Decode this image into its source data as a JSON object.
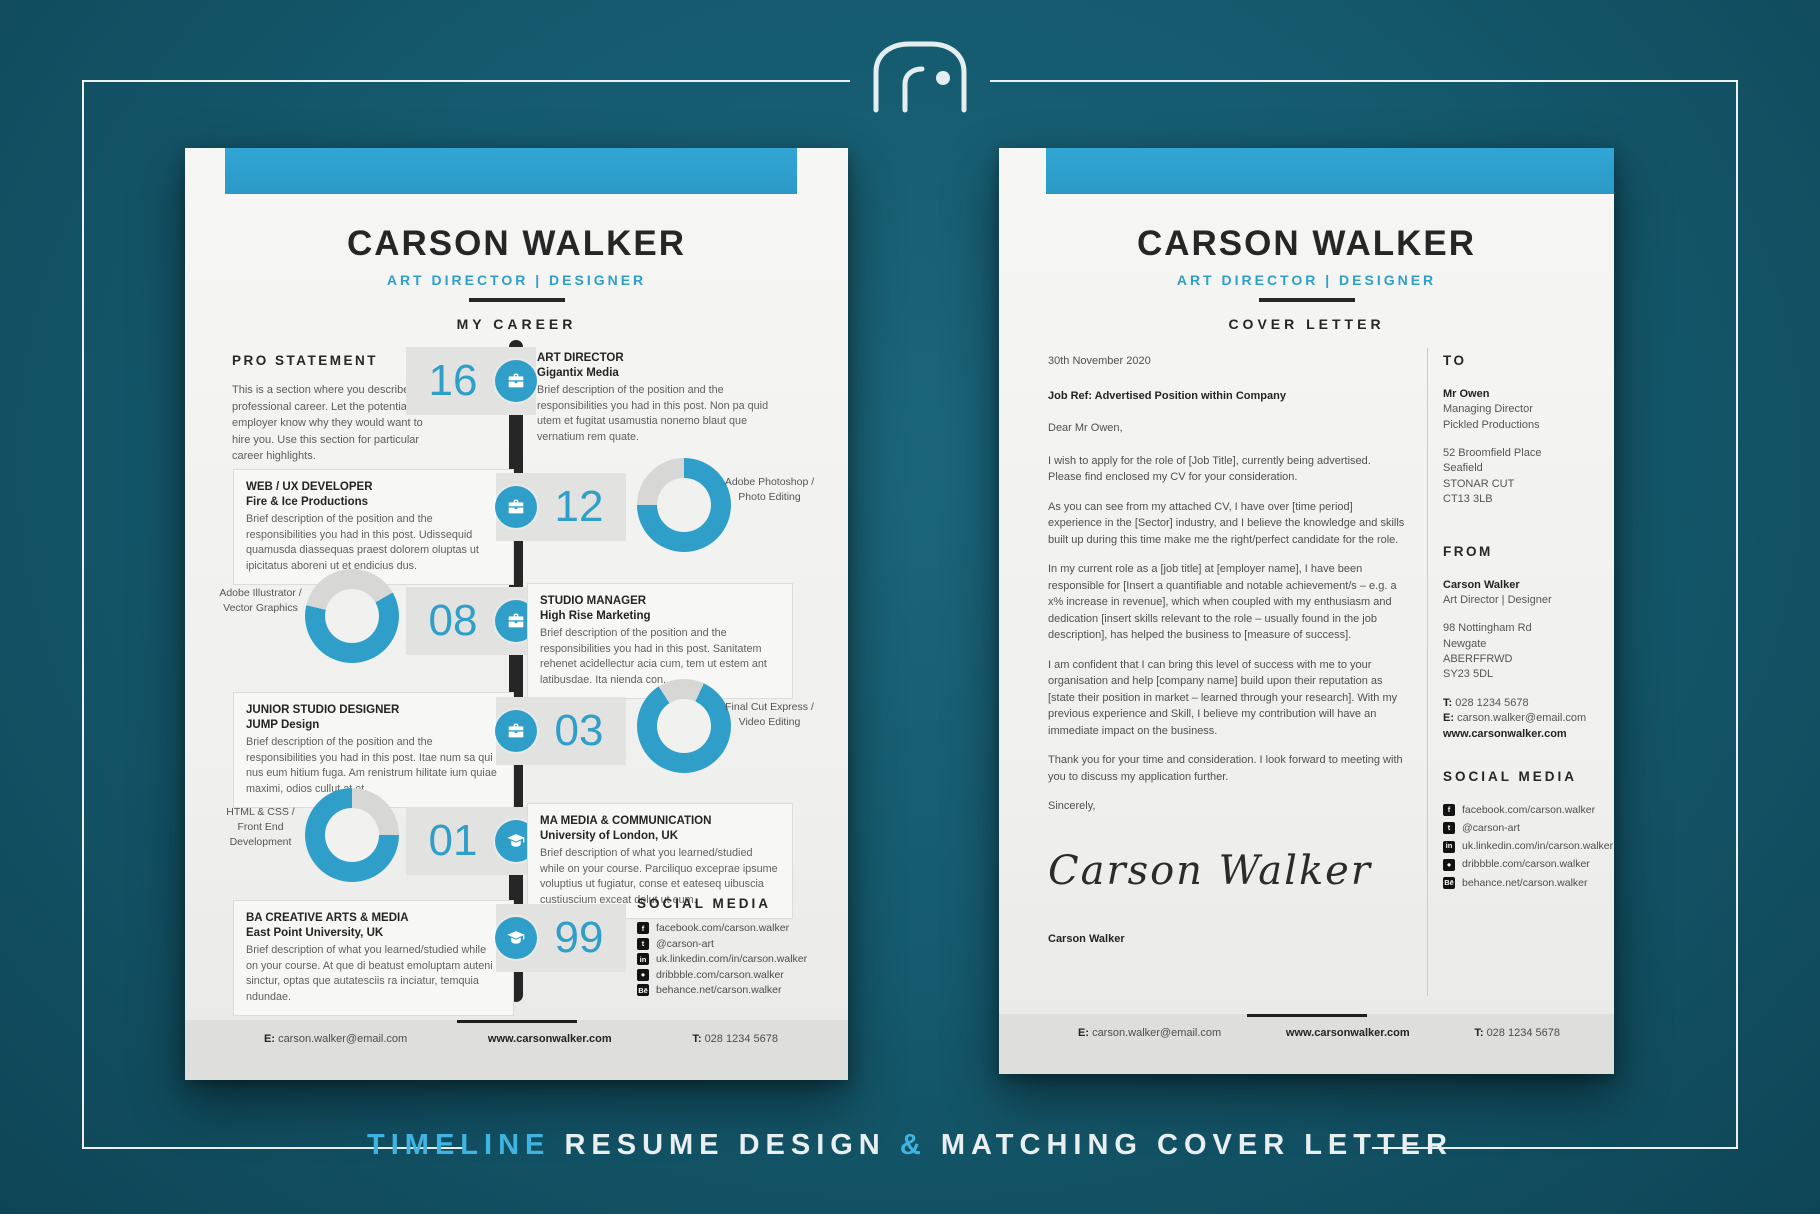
{
  "colors": {
    "teal_bg": "#14586c",
    "accent_blue": "#2f9fca",
    "caption_blue": "#41b3e0",
    "paper": "#f3f3f1",
    "donut_track": "#d7d7d5",
    "timeline_bar": "#262626"
  },
  "caption": {
    "part1": "TIMELINE",
    "part2": "RESUME DESIGN",
    "amp": "&",
    "part3": "MATCHING COVER LETTER"
  },
  "person": {
    "name": "CARSON WALKER",
    "tagline": "ART DIRECTOR | DESIGNER"
  },
  "social": {
    "heading": "SOCIAL MEDIA",
    "items": [
      {
        "icon": "facebook-icon",
        "glyph": "f",
        "text": "facebook.com/carson.walker"
      },
      {
        "icon": "twitter-icon",
        "glyph": "t",
        "text": "@carson-art"
      },
      {
        "icon": "linkedin-icon",
        "glyph": "in",
        "text": "uk.linkedin.com/in/carson.walker"
      },
      {
        "icon": "dribbble-icon",
        "glyph": "●",
        "text": "dribbble.com/carson.walker"
      },
      {
        "icon": "behance-icon",
        "glyph": "Bē",
        "text": "behance.net/carson.walker"
      }
    ]
  },
  "footer": {
    "email_label": "E:",
    "email": "carson.walker@email.com",
    "website": "www.carsonwalker.com",
    "phone_label": "T:",
    "phone": "028 1234 5678"
  },
  "resume": {
    "section_title": "MY CAREER",
    "pro_statement": {
      "heading": "PRO STATEMENT",
      "body": "This is a section where you describe your professional career. Let the potential employer know why they would want to hire you. Use this section for particular career highlights."
    },
    "timeline": [
      {
        "year": "16",
        "icon": "briefcase-icon",
        "title": "ART DIRECTOR",
        "org": "Gigantix Media",
        "desc": "Brief description of the position and the responsibilities you had in this post. Non pa quid utem et fugitat usamustia nonemo blaut que vernatium rem quate."
      },
      {
        "year": "12",
        "icon": "briefcase-icon",
        "title": "WEB / UX DEVELOPER",
        "org": "Fire & Ice Productions",
        "desc": "Brief description of the position and the responsibilities you had in this post. Udissequid quamusda diassequas praest dolorem oluptas ut ipicitatus aboreni ut et endicius dus.",
        "skill": {
          "label": "Adobe Photoshop / Photo Editing",
          "percent": 75,
          "start_deg": 0
        }
      },
      {
        "year": "08",
        "icon": "briefcase-icon",
        "title": "STUDIO MANAGER",
        "org": "High Rise Marketing",
        "desc": "Brief description of the position and the responsibilities you had in this post. Sanitatem rehenet acidellectur acia cum, tem ut estem ant latibusdae. Ita nienda con.",
        "skill": {
          "label": "Adobe Illustrator / Vector Graphics",
          "percent": 62,
          "start_deg": 60
        }
      },
      {
        "year": "03",
        "icon": "briefcase-icon",
        "title": "JUNIOR STUDIO DESIGNER",
        "org": "JUMP Design",
        "desc": "Brief description of the position and the responsibilities you had in this post. Itae num sa qui nus eum hitium fuga. Am renistrum hilitate ium quiae maximi, odios cullut at et.",
        "skill": {
          "label": "Final Cut Express / Video Editing",
          "percent": 84,
          "start_deg": 25
        }
      },
      {
        "year": "01",
        "icon": "graduation-cap-icon",
        "title": "MA MEDIA & COMMUNICATION",
        "org": "University of London, UK",
        "desc": "Brief description of what you learned/studied while on your course. Parciliquo exceprae ipsume voluptius ut fugiatur, conse et eateseq uibuscia custiuscium exceat dolut ut eum.",
        "skill": {
          "label": "HTML & CSS / Front End Development",
          "percent": 75,
          "start_deg": 90
        }
      },
      {
        "year": "99",
        "icon": "graduation-cap-icon",
        "title": "BA CREATIVE ARTS & MEDIA",
        "org": "East Point University, UK",
        "desc": "Brief description of what you learned/studied while on your course. At que di beatust emoluptam auteni sinctur, optas que autatesciis ra inciatur, temquia ndundae."
      }
    ]
  },
  "cover": {
    "section_title": "COVER LETTER",
    "date": "30th November 2020",
    "job_ref": "Job Ref: Advertised Position within Company",
    "salutation": "Dear Mr Owen,",
    "paragraphs": [
      "I wish to apply for the role of [Job Title], currently being advertised. Please find enclosed my CV for your consideration.",
      "As you can see from my attached CV, I have over [time period] experience in the [Sector] industry, and I believe the knowledge and skills built up during this time make me the right/perfect candidate for the role.",
      "In my current role as a [job title] at [employer name], I have been responsible for [Insert a quantifiable and notable achievement/s – e.g. a x% increase in revenue], which when coupled with my enthusiasm and dedication [insert skills relevant to the role – usually found in the job description], has helped the business to [measure of success].",
      "I am confident that I can bring this level of success with me to your organisation and help [company name] build upon their reputation as [state their position in market – learned through your research]. With my previous experience and Skill, I believe my contribution will have an immediate impact on the business.",
      "Thank you for your time and consideration. I look forward to meeting with you to discuss my application further."
    ],
    "closing": "Sincerely,",
    "signature": "Carson Walker",
    "signed_name": "Carson Walker",
    "to": {
      "heading": "TO",
      "name": "Mr Owen",
      "role": "Managing Director",
      "company": "Pickled Productions",
      "address": [
        "52 Broomfield Place",
        "Seafield",
        "STONAR CUT",
        "CT13 3LB"
      ]
    },
    "from": {
      "heading": "FROM",
      "name": "Carson Walker",
      "role": "Art Director | Designer",
      "address": [
        "98 Nottingham Rd",
        "Newgate",
        "ABERFFRWD",
        "SY23 5DL"
      ],
      "phone_label": "T:",
      "phone": "028 1234 5678",
      "email_label": "E:",
      "email": "carson.walker@email.com",
      "website": "www.carsonwalker.com"
    }
  }
}
